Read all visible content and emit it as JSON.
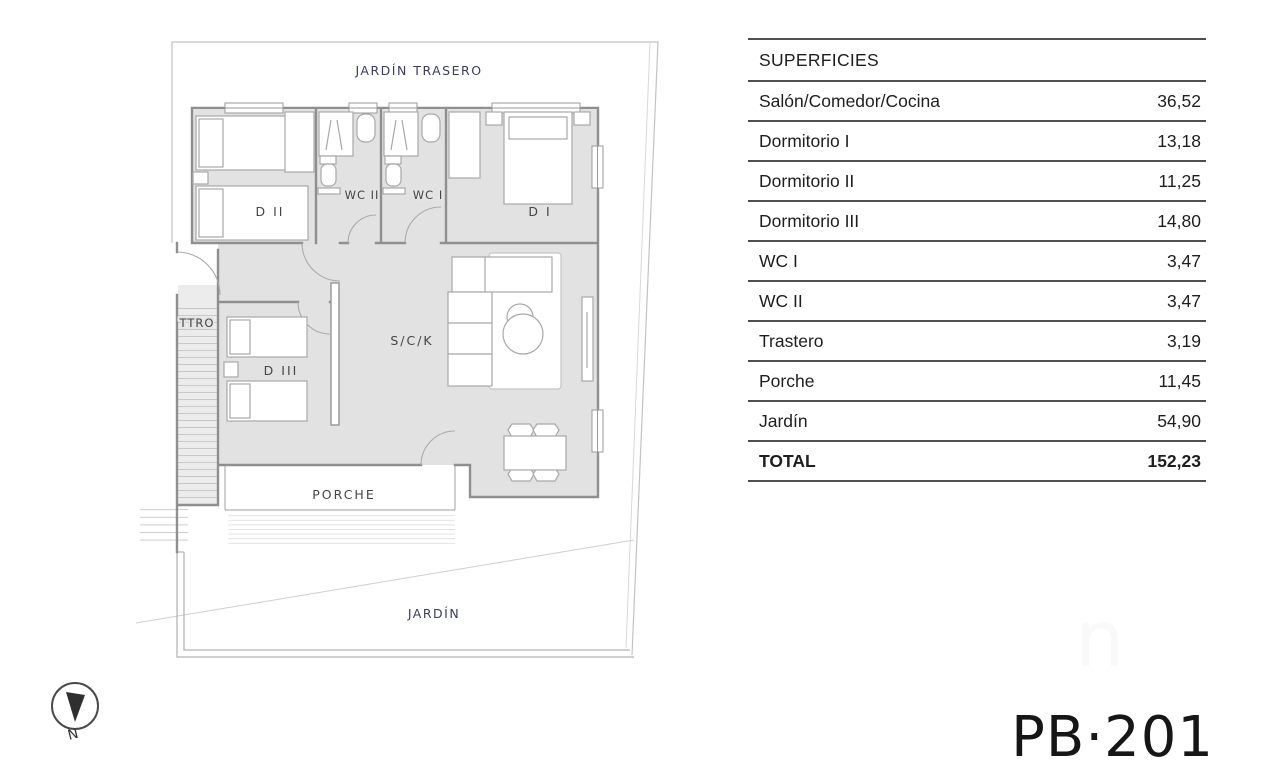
{
  "plan_code": "PB·201",
  "watermark_glyph": "n",
  "table": {
    "header": "SUPERFICIES",
    "rows": [
      {
        "label": "Salón/Comedor/Cocina",
        "value": "36,52"
      },
      {
        "label": "Dormitorio I",
        "value": "13,18"
      },
      {
        "label": "Dormitorio II",
        "value": "11,25"
      },
      {
        "label": "Dormitorio III",
        "value": "14,80"
      },
      {
        "label": "WC I",
        "value": "3,47"
      },
      {
        "label": "WC II",
        "value": "3,47"
      },
      {
        "label": "Trastero",
        "value": "3,19"
      },
      {
        "label": "Porche",
        "value": "11,45"
      },
      {
        "label": "Jardín",
        "value": "54,90"
      }
    ],
    "total": {
      "label": "TOTAL",
      "value": "152,23"
    }
  },
  "plan": {
    "labels": {
      "back_garden": "JARDÍN TRASERO",
      "bedroom2": "D II",
      "wc2": "WC II",
      "wc1": "WC I",
      "bedroom1": "D I",
      "storage": "TTRO",
      "bedroom3": "D III",
      "living": "S/C/K",
      "porch": "PORCHE",
      "garden": "JARDÍN"
    },
    "colors": {
      "room_fill": "#e2e2e2",
      "storage_fill": "#ececec",
      "wall": "#8f8f8f",
      "furniture_stroke": "#a8a8a8",
      "boundary": "#c2c2c2",
      "garden_label_text": "#3b3b63",
      "room_label_text": "#454545",
      "table_line": "#4f4f4f"
    }
  },
  "compass": {
    "north_label": "N"
  }
}
